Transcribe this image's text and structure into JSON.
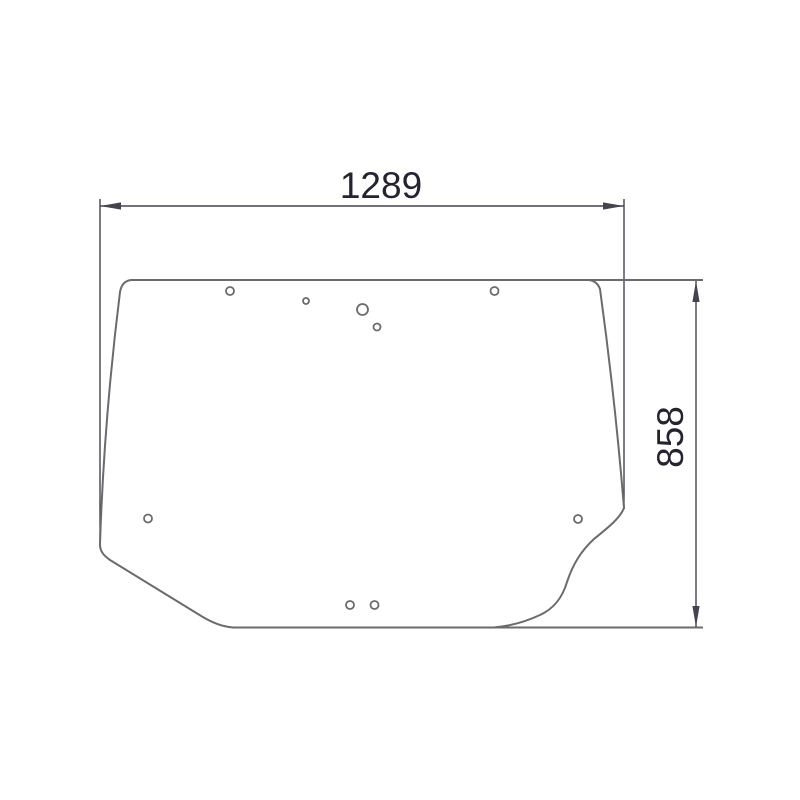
{
  "drawing": {
    "width_label": "1289",
    "height_label": "858",
    "colors": {
      "background": "#ffffff",
      "outline": "#6b6b6b",
      "dimension": "#474250",
      "label": "#262230"
    },
    "holes": [
      {
        "cx": 230,
        "cy": 291,
        "r": 4
      },
      {
        "cx": 306,
        "cy": 301,
        "r": 3
      },
      {
        "cx": 362.5,
        "cy": 309.5,
        "r": 5.5
      },
      {
        "cx": 377,
        "cy": 327,
        "r": 3.5
      },
      {
        "cx": 494.5,
        "cy": 291,
        "r": 4
      },
      {
        "cx": 148,
        "cy": 518.5,
        "r": 4
      },
      {
        "cx": 578,
        "cy": 519,
        "r": 4
      },
      {
        "cx": 350,
        "cy": 605,
        "r": 4
      },
      {
        "cx": 374.5,
        "cy": 605,
        "r": 4
      }
    ]
  }
}
